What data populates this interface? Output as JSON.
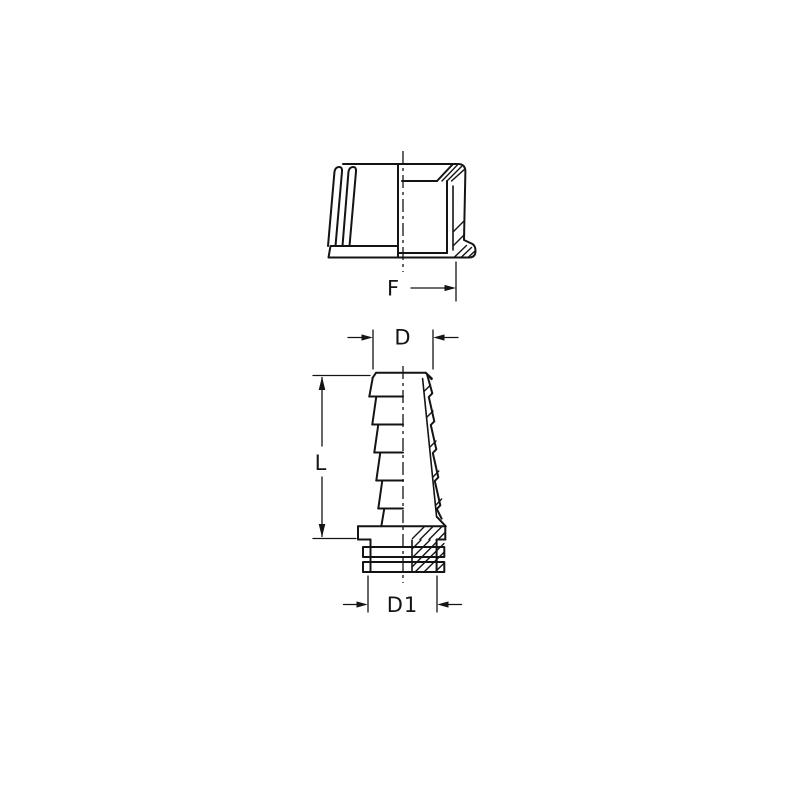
{
  "colors": {
    "ink": "#141414",
    "background": "#ffffff"
  },
  "dimensions": {
    "f_label": "F",
    "d_label": "D",
    "l_label": "L",
    "d1_label": "D1"
  }
}
